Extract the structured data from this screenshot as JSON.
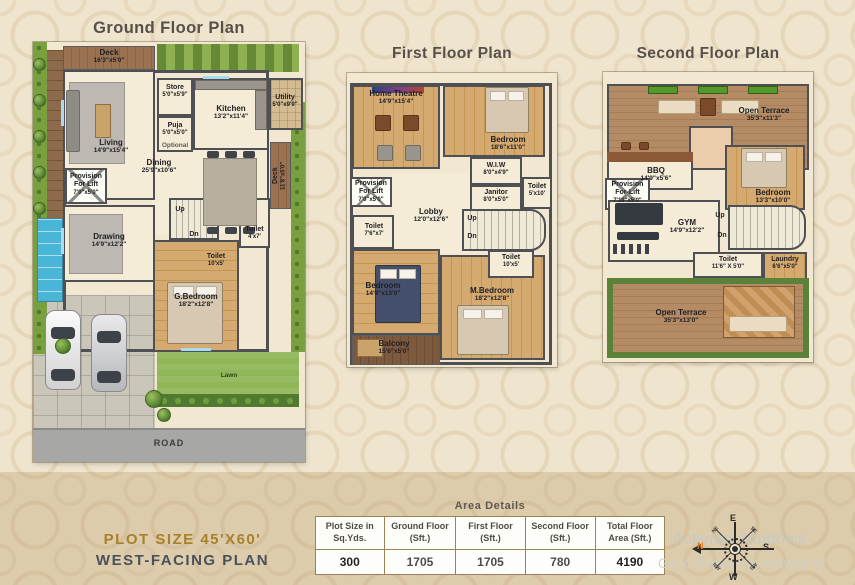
{
  "titles": {
    "ground": "Ground Floor Plan",
    "first": "First Floor Plan",
    "second": "Second Floor Plan"
  },
  "ground": {
    "rooms": {
      "deck_top": {
        "name": "Deck",
        "dims": "16'3\"x5'0\""
      },
      "store": {
        "name": "Store",
        "dims": "5'0\"x5'9\""
      },
      "kitchen": {
        "name": "Kitchen",
        "dims": "13'2\"x11'4\""
      },
      "utility": {
        "name": "Utility",
        "dims": "5'0\"x9'9\""
      },
      "puja": {
        "name": "Puja",
        "dims": "5'0\"x5'0\""
      },
      "optional": "Optional",
      "living": {
        "name": "Living",
        "dims": "14'9\"x15'4\""
      },
      "dining": {
        "name": "Dining",
        "dims": "25'9\"x10'6\""
      },
      "lift": {
        "line1": "Provision",
        "line2": "For Lift",
        "dims": "7'0\"x5'0\""
      },
      "deck_right": {
        "name": "Deck",
        "dims": "11'8\"x5'0\""
      },
      "drawing": {
        "name": "Drawing",
        "dims": "14'9\"x12'2\""
      },
      "toilet_a": {
        "name": "Toilet",
        "dims": "4'x7'"
      },
      "toilet_b": {
        "name": "Toilet",
        "dims": "10'x5'"
      },
      "g_bedroom": {
        "name": "G.Bedroom",
        "dims": "18'2\"x12'8\""
      },
      "up": "Up",
      "dn": "Dn",
      "lawn": "Lawn",
      "road": "ROAD"
    }
  },
  "first": {
    "rooms": {
      "home_theatre": {
        "name": "Home Theatre",
        "dims": "14'9\"x15'4\""
      },
      "bedroom": {
        "name": "Bedroom",
        "dims": "18'6\"x11'0\""
      },
      "wiw": {
        "name": "W.I.W",
        "dims": "8'0\"x4'9\""
      },
      "janitor": {
        "name": "Janitor",
        "dims": "8'0\"x5'0\""
      },
      "toilet_r": {
        "name": "Toilet",
        "dims": "5'x10'"
      },
      "lift": {
        "line1": "Provision",
        "line2": "For Lift",
        "dims": "7'0\"x5'0\""
      },
      "lobby": {
        "name": "Lobby",
        "dims": "12'0\"x12'6\""
      },
      "toilet_l": {
        "name": "Toilet",
        "dims": "7'6\"x7'"
      },
      "bedroom2": {
        "name": "Bedroom",
        "dims": "14'9\"x13'0\""
      },
      "m_bedroom": {
        "name": "M.Bedroom",
        "dims": "18'2\"x12'8\""
      },
      "toilet_m": {
        "name": "Toilet",
        "dims": "10'x5'"
      },
      "balcony": {
        "name": "Balcony",
        "dims": "15'6\"x5'0\""
      },
      "up": "Up",
      "dn": "Dn"
    }
  },
  "second": {
    "rooms": {
      "terrace_top": {
        "name": "Open Terrace",
        "dims": "35'3\"x11'3\""
      },
      "bbq": {
        "name": "BBQ",
        "dims": "14'9\"x5'6\""
      },
      "lift": {
        "line1": "Provision",
        "line2": "For-Lift",
        "dims": "7'10\"x5'0\""
      },
      "bedroom": {
        "name": "Bedroom",
        "dims": "13'3\"x10'0\""
      },
      "gym": {
        "name": "GYM",
        "dims": "14'9\"x12'2\""
      },
      "toilet": {
        "name": "Toilet",
        "dims": "11'6\" X 5'0\""
      },
      "laundry": {
        "name": "Laundry",
        "dims": "6'6\"x5'0\""
      },
      "terrace_bottom": {
        "name": "Open Terrace",
        "dims": "35'3\"x13'0\""
      },
      "up": "Up",
      "dn": "Dn"
    }
  },
  "area_details": {
    "title": "Area Details",
    "columns": [
      {
        "header": "Plot Size in Sq.Yds.",
        "value": "300"
      },
      {
        "header": "Ground Floor (Sft.)",
        "value": "1705"
      },
      {
        "header": "First Floor (Sft.)",
        "value": "1705"
      },
      {
        "header": "Second Floor (Sft.)",
        "value": "780"
      },
      {
        "header": "Total Floor Area (Sft.)",
        "value": "4190"
      }
    ]
  },
  "footer": {
    "plot_size": "PLOT SIZE 45'X60'",
    "facing": "WEST-FACING PLAN"
  },
  "compass": {
    "n": "N",
    "e": "E",
    "s": "S",
    "w": "W",
    "ne": "NE",
    "se": "SE",
    "sw": "SW",
    "nw": "NW"
  },
  "watermark": {
    "line1": "Activate Windows",
    "line2": "Go to Settings to activate W"
  }
}
